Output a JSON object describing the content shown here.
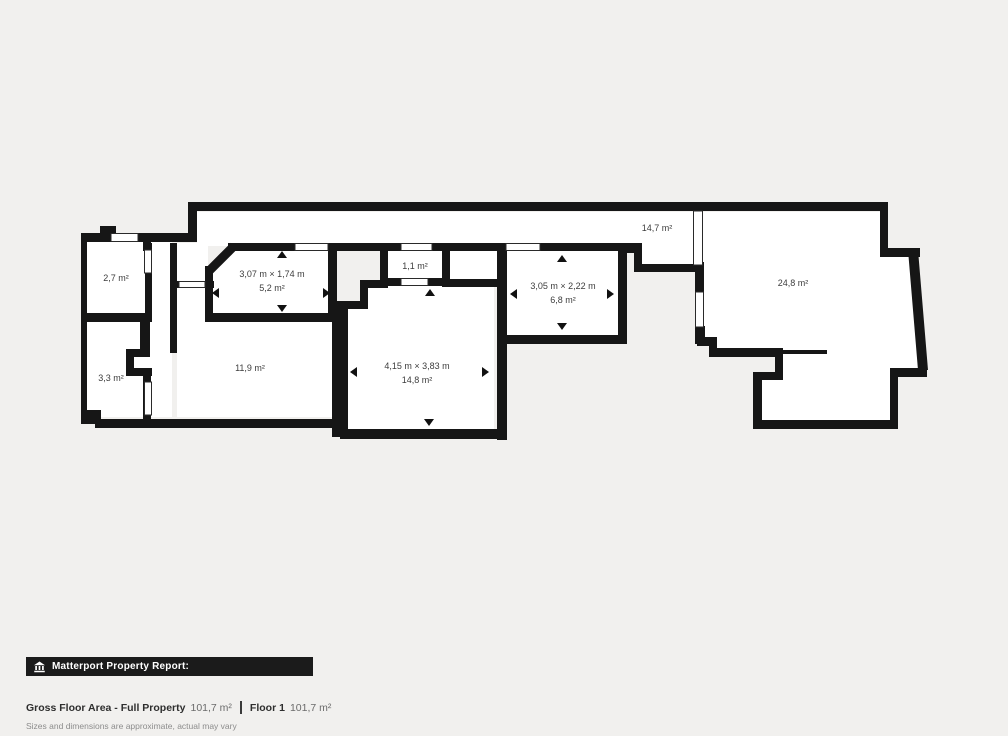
{
  "page": {
    "background": "#f1f0ee"
  },
  "floorplan": {
    "wall_color": "#161616",
    "room_fill": "#ffffff",
    "label_color": "#3d3d3d",
    "rooms": [
      {
        "name": "room-2-7",
        "area": "2,7 m²"
      },
      {
        "name": "room-3-3",
        "area": "3,3 m²"
      },
      {
        "name": "room-11-9",
        "area": "11,9 m²"
      },
      {
        "name": "room-5-2",
        "dims": "3,07 m × 1,74 m",
        "area": "5,2 m²"
      },
      {
        "name": "room-1-1",
        "area": "1,1 m²"
      },
      {
        "name": "room-14-8",
        "dims": "4,15 m × 3,83 m",
        "area": "14,8 m²"
      },
      {
        "name": "room-6-8",
        "dims": "3,05 m × 2,22 m",
        "area": "6,8 m²"
      },
      {
        "name": "corridor-14-7",
        "area": "14,7 m²"
      },
      {
        "name": "room-24-8",
        "area": "24,8 m²"
      }
    ]
  },
  "footer": {
    "report_bar": {
      "label": "Matterport Property Report:",
      "background": "#1b1b1b",
      "icon": "building-icon"
    },
    "summary": {
      "gross_label": "Gross Floor Area - Full Property",
      "gross_value": "101,7 m²",
      "floor_label": "Floor 1",
      "floor_value": "101,7 m²"
    },
    "disclaimer": "Sizes and dimensions are approximate, actual may vary"
  }
}
